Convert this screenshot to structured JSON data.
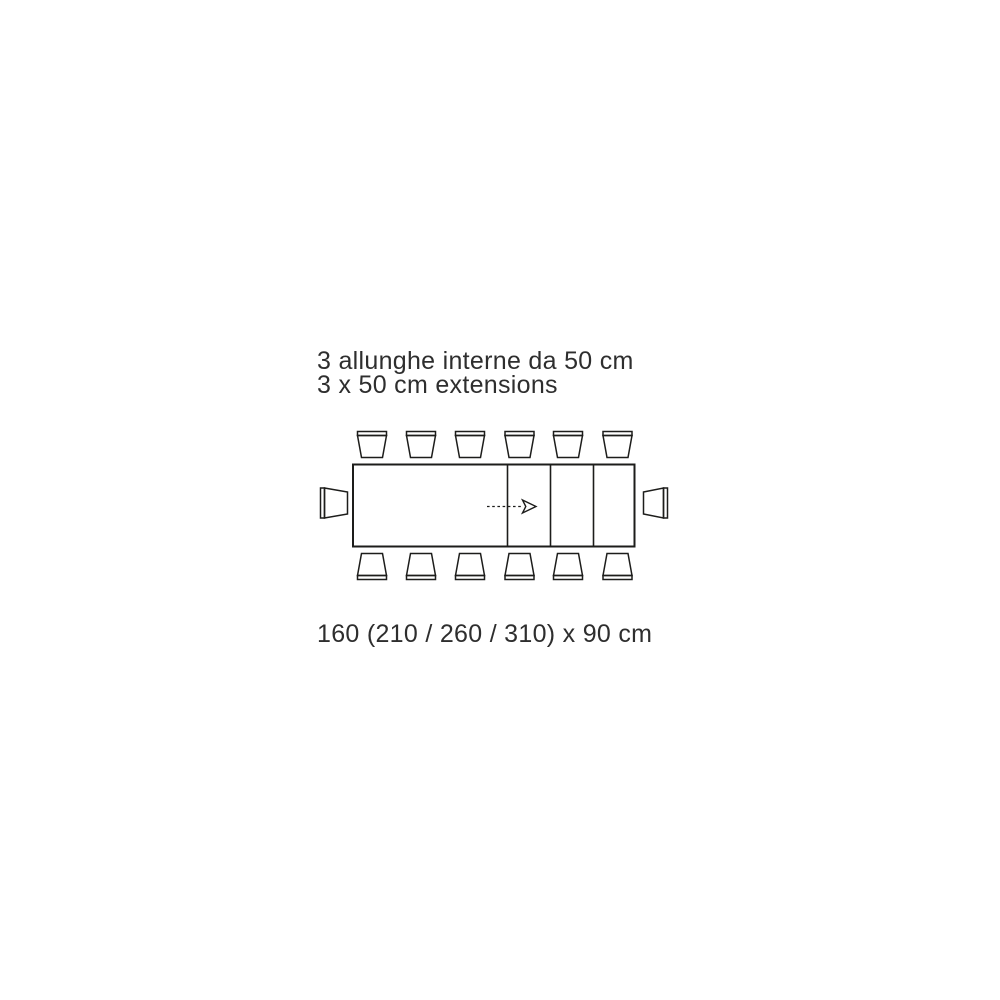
{
  "page": {
    "background_color": "#ffffff"
  },
  "colors": {
    "line": "#1d1d1b",
    "text": "#2e2e2e"
  },
  "caption": {
    "line1": "3 allunghe interne da 50 cm",
    "line2": "3 x 50 cm extensions"
  },
  "dimensions": {
    "label": "160 (210 / 260 / 310) x 90 cm"
  },
  "diagram": {
    "description": "top-view plan of extendable rectangular dining table with chairs",
    "table": {
      "closed_length_cm": 160,
      "extended_lengths_cm": [
        210,
        260,
        310
      ],
      "depth_cm": 90,
      "extensions_count": 3,
      "extension_size_cm": 50
    },
    "chairs": {
      "top": 6,
      "bottom": 6,
      "left": 1,
      "right": 1,
      "total": 14
    },
    "arrow": {
      "direction": "right",
      "style": "dashed"
    }
  }
}
